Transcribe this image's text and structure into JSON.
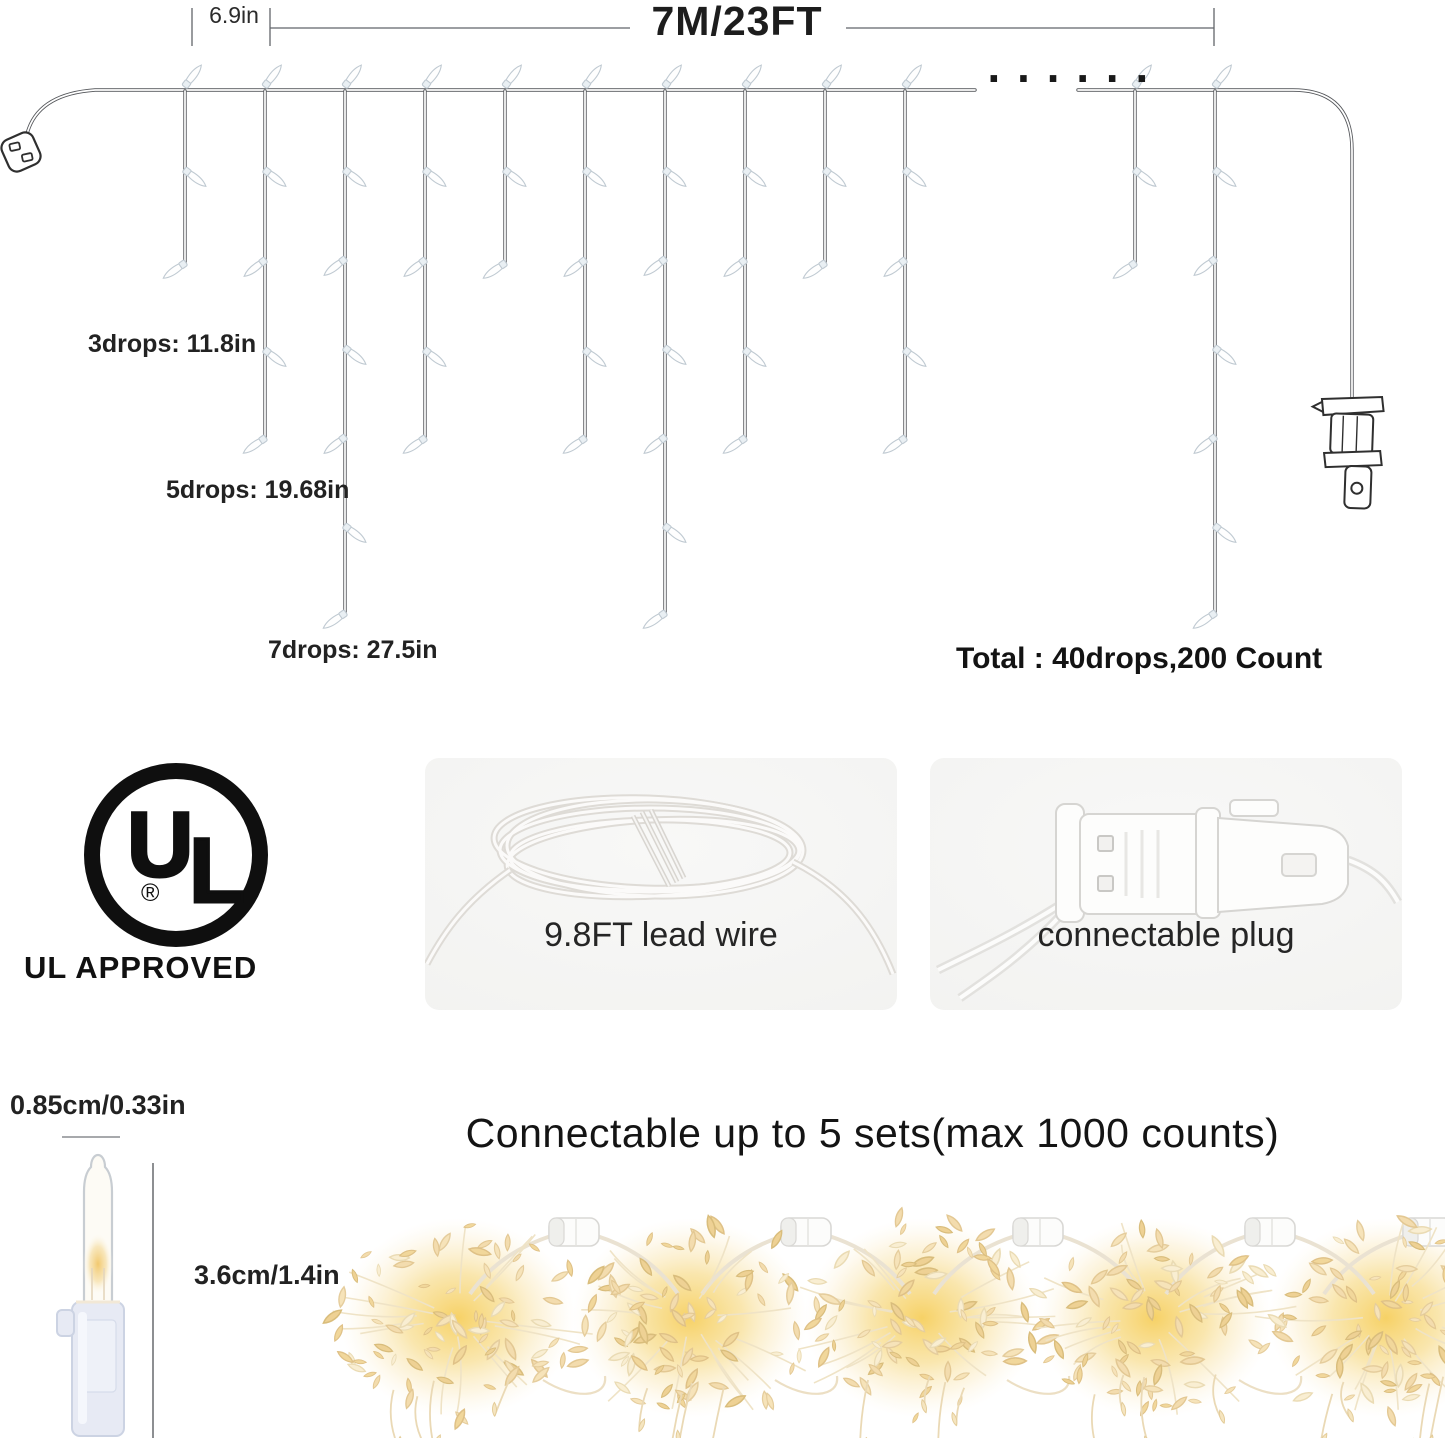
{
  "diagram": {
    "spacing_label": "6.9in",
    "length_label": "7M/23FT",
    "continuation_dots": "......",
    "drop_length_labels": [
      "3drops: 11.8in",
      "5drops: 19.68in",
      "7drops: 27.5in"
    ],
    "total_label": "Total : 40drops,200 Count",
    "wire_y": 90,
    "drops": [
      {
        "x": 185,
        "bulbs": 3,
        "end": 265
      },
      {
        "x": 265,
        "bulbs": 5,
        "end": 440
      },
      {
        "x": 345,
        "bulbs": 7,
        "end": 615
      },
      {
        "x": 425,
        "bulbs": 5,
        "end": 440
      },
      {
        "x": 505,
        "bulbs": 3,
        "end": 265
      },
      {
        "x": 585,
        "bulbs": 5,
        "end": 440
      },
      {
        "x": 665,
        "bulbs": 7,
        "end": 615
      },
      {
        "x": 745,
        "bulbs": 5,
        "end": 440
      },
      {
        "x": 825,
        "bulbs": 3,
        "end": 265
      },
      {
        "x": 905,
        "bulbs": 5,
        "end": 440
      },
      {
        "x": 1135,
        "bulbs": 3,
        "end": 265
      },
      {
        "x": 1215,
        "bulbs": 7,
        "end": 615
      }
    ]
  },
  "certification": {
    "mark": "UL",
    "registered": "®",
    "caption": "UL APPROVED"
  },
  "features": [
    {
      "caption": "9.8FT lead wire"
    },
    {
      "caption": "connectable plug"
    }
  ],
  "bulb_detail": {
    "diameter_label": "0.85cm/0.33in",
    "height_label": "3.6cm/1.4in"
  },
  "connectivity": {
    "heading": "Connectable up to 5 sets(max 1000 counts)",
    "set_count": 5
  },
  "colors": {
    "line": "#54565a",
    "text": "#1c1c1c",
    "panel_bg": "#f1f1ef",
    "warm_glow": "#f6cf5e",
    "warm_pale": "#f9eed2"
  }
}
